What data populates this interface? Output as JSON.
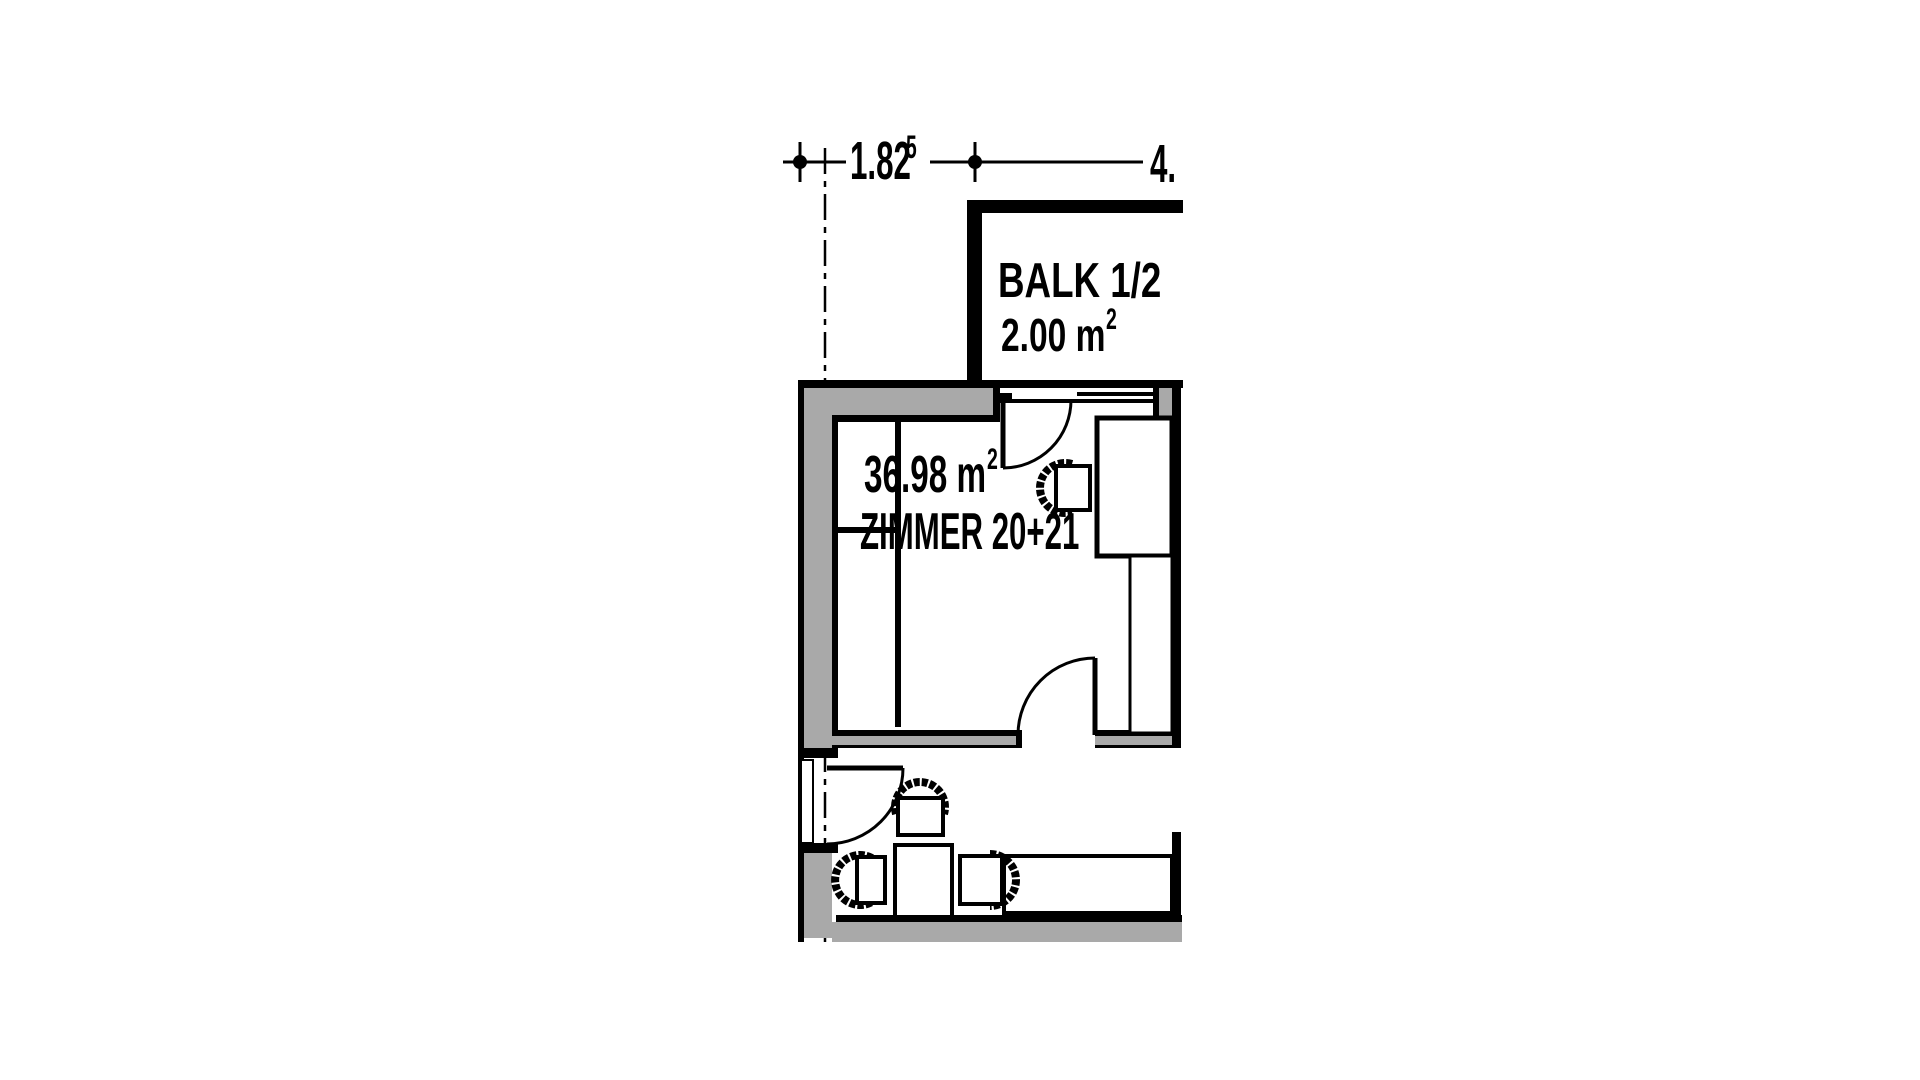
{
  "plan": {
    "dimension_labels": {
      "dim1_value": "1.82",
      "dim1_superscript": "5",
      "dim2_value": "4."
    },
    "room_labels": {
      "balcony_name": "BALK 1/2",
      "balcony_area": "2.00 m",
      "balcony_area_superscript": "2",
      "room_area": "36.98 m",
      "room_area_superscript": "2",
      "room_name": "ZIMMER 20+21"
    },
    "colors": {
      "wall_fill_gray": "#a9a9a9",
      "line_black": "#000000",
      "background": "#ffffff"
    }
  }
}
